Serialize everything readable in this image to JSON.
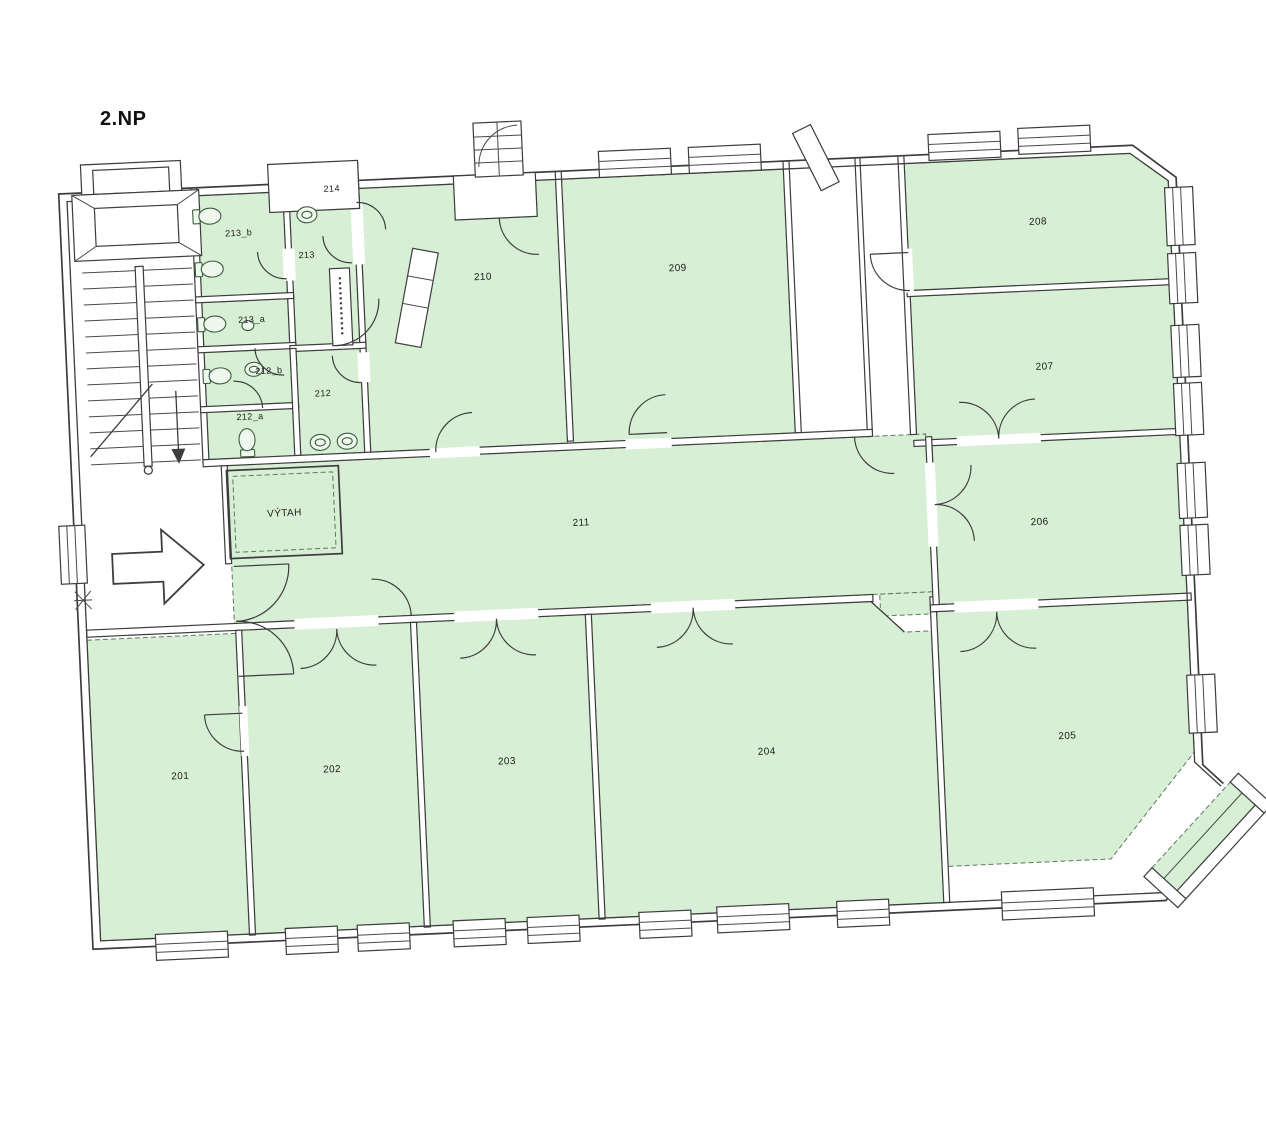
{
  "page": {
    "title": "2.NP"
  },
  "colors": {
    "room_fill": "#d7efd4",
    "wall_line": "#3d3d3d",
    "page_background": "#ffffff"
  },
  "rooms": {
    "r201": {
      "label": "201"
    },
    "r202": {
      "label": "202"
    },
    "r203": {
      "label": "203"
    },
    "r204": {
      "label": "204"
    },
    "r205": {
      "label": "205"
    },
    "r206": {
      "label": "206"
    },
    "r207": {
      "label": "207"
    },
    "r208": {
      "label": "208"
    },
    "r209": {
      "label": "209"
    },
    "r210": {
      "label": "210"
    },
    "r211": {
      "label": "211"
    },
    "r212": {
      "label": "212"
    },
    "r212a": {
      "label": "212_a"
    },
    "r212b": {
      "label": "212_b"
    },
    "r213": {
      "label": "213"
    },
    "r213a": {
      "label": "213_a"
    },
    "r213b": {
      "label": "213_b"
    },
    "r214": {
      "label": "214"
    },
    "elevator": {
      "label": "VÝTAH"
    }
  }
}
